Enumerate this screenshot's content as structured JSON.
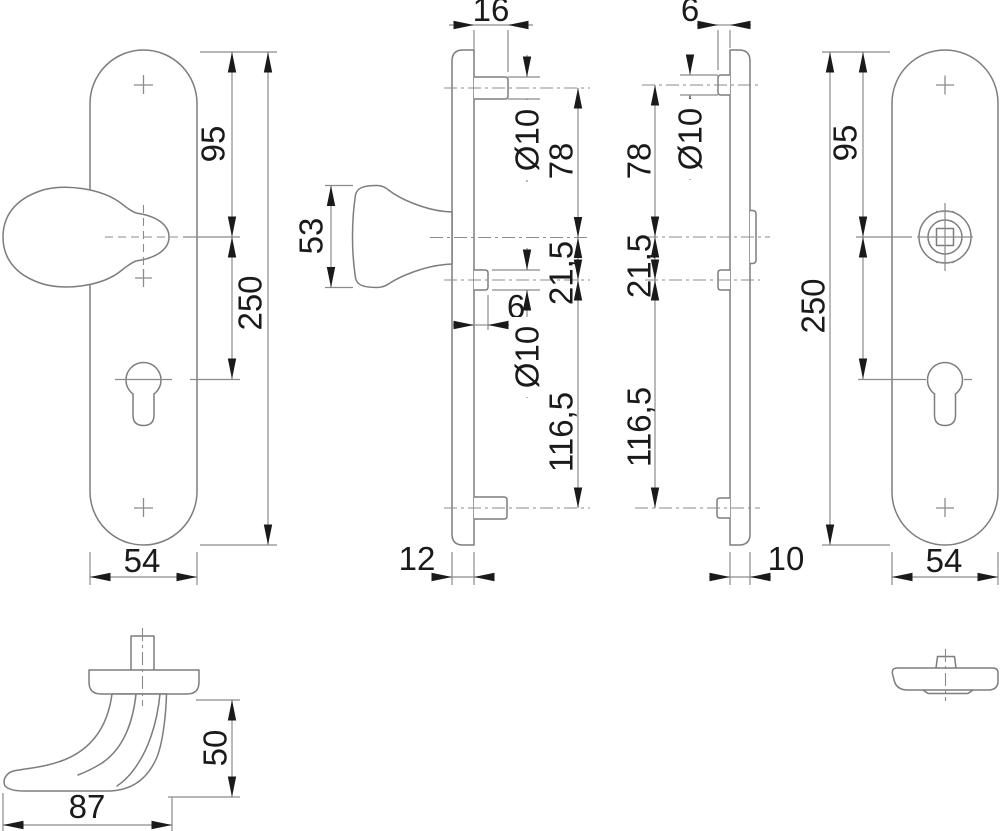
{
  "colors": {
    "background": "#ffffff",
    "geometry_line": "#7d7d7d",
    "dimension_line": "#8b8b8b",
    "annotation": "#1a1a1a"
  },
  "views": {
    "knob_plate_front": {
      "dims": {
        "top_to_knob_center": "95",
        "plate_height": "250",
        "plate_width": "54"
      }
    },
    "knob_plate_side": {
      "dims": {
        "top_stud_length": "16",
        "knob_depth": "53",
        "top_stud_diameter": "Ø10",
        "top_stud_to_center": "78",
        "center_to_cylinder_screw": "21,5",
        "cylinder_screw_stud_length": "6",
        "cylinder_screw_diameter": "Ø10",
        "cylinder_screw_to_bottom_stud": "116,5",
        "plate_thickness": "12"
      }
    },
    "lever_plate_side": {
      "dims": {
        "stud_length": "6",
        "stud_diameter": "Ø10",
        "top_stud_to_center": "78",
        "center_to_cylinder_screw": "21,5",
        "cylinder_screw_to_bottom_stud": "116,5",
        "plate_thickness": "10"
      }
    },
    "lever_plate_front": {
      "dims": {
        "top_to_spindle_center": "95",
        "plate_height": "250",
        "plate_width": "54"
      }
    },
    "lever_handle_side": {
      "dims": {
        "grip_height": "50",
        "grip_length": "87"
      }
    }
  }
}
